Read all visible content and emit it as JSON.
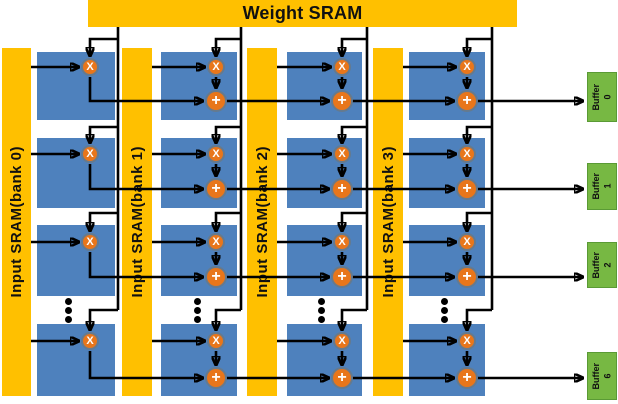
{
  "colors": {
    "sram-yellow": "#FFC000",
    "pe-blue": "#4E81BD",
    "op-orange": "#E8761B",
    "op-ring": "#657a8e",
    "buffer-green": "#77B843",
    "wire-black": "#000000"
  },
  "weight_sram": {
    "label": "Weight SRAM"
  },
  "input_banks": [
    {
      "label": "Input SRAM(bank 0)"
    },
    {
      "label": "Input SRAM(bank 1)"
    },
    {
      "label": "Input SRAM(bank 2)"
    },
    {
      "label": "Input SRAM(bank 3)"
    }
  ],
  "pe_array": {
    "columns": 4,
    "rows_shown": 4,
    "symbols": {
      "multiply": "X",
      "add": "+"
    }
  },
  "output_buffers": [
    {
      "label": "Buffer",
      "index": "0"
    },
    {
      "label": "Buffer",
      "index": "1"
    },
    {
      "label": "Buffer",
      "index": "2"
    },
    {
      "label": "Buffer",
      "index": "6"
    }
  ],
  "icons": {
    "ellipsis": "vertical-dots (rows elided)"
  }
}
